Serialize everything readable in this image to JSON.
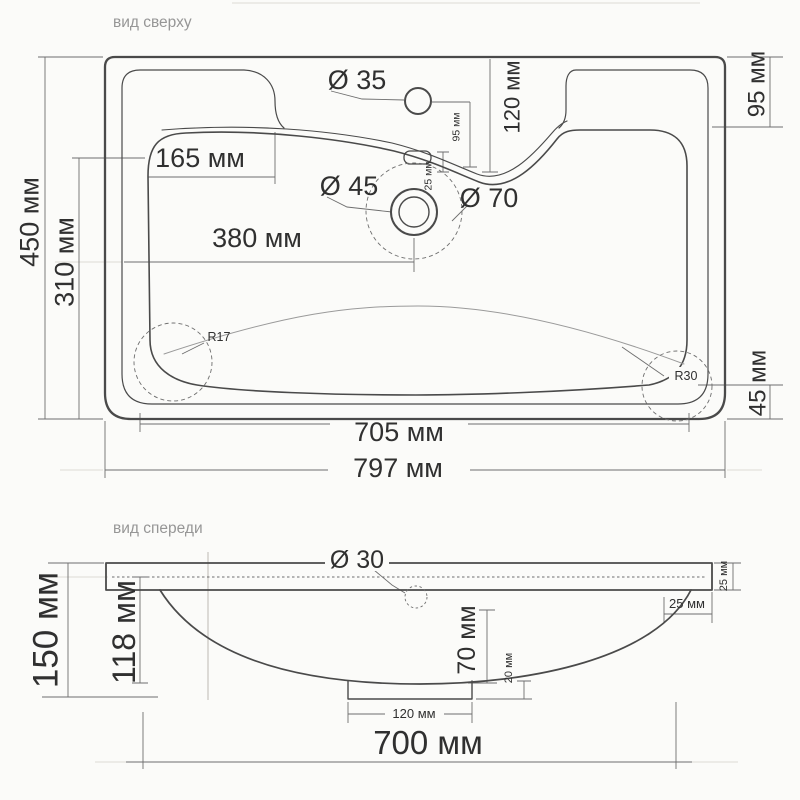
{
  "colors": {
    "line": "#4a4a4a",
    "dim_line": "#6e6e6e",
    "text": "#303030",
    "muted_title": "#969696",
    "background": "#fbfbf9"
  },
  "top": {
    "title": "вид сверху",
    "dims": {
      "dia35": "Ø 35",
      "dia45": "Ø 45",
      "dia70": "Ø 70",
      "w165": "165 мм",
      "w380": "380 мм",
      "v120": "120 мм",
      "v95": "95 мм",
      "v25": "25 мм",
      "r17": "R17",
      "r30": "R30",
      "left450": "450 мм",
      "left310": "310 мм",
      "right95": "95 мм",
      "right45": "45 мм",
      "b705": "705 мм",
      "b797": "797 мм"
    }
  },
  "front": {
    "title": "вид спереди",
    "dims": {
      "dia30": "Ø 30",
      "left150": "150 мм",
      "left118": "118 мм",
      "d70": "70 мм",
      "d20": "20 мм",
      "t25v": "25 мм",
      "t25h": "25 мм",
      "boss120": "120 мм",
      "b700": "700 мм"
    }
  }
}
